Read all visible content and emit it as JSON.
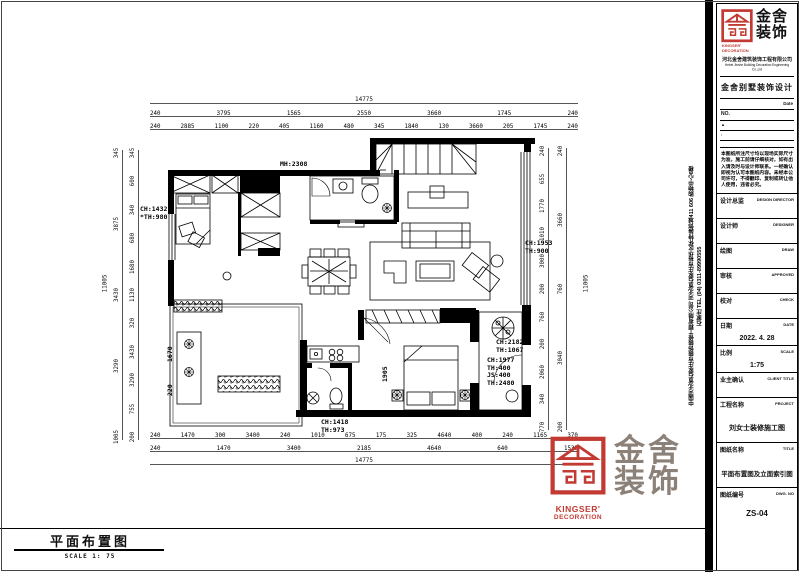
{
  "colors": {
    "brand_red": "#c23a32",
    "watermark_gray": "#8b8179"
  },
  "footer": {
    "title": "平面布置图",
    "scale": "SCALE 1: 75"
  },
  "brand": {
    "char1": "金",
    "char2": "舍",
    "char3": "装",
    "char4": "饰",
    "chars": "金舍装饰",
    "en1": "KINGSER'",
    "en2": "DECORATION"
  },
  "titleblock": {
    "company_cn": "河北金舍建筑装饰工程有限公司",
    "company_en": "Hebei Jinshe Building Decoration Engineering Co.,Ltd",
    "product": "金舍别墅装饰设计",
    "date_label": "Date",
    "no_label": "NO.",
    "tri": "▲",
    "colon": ":",
    "notice": "本图纸所注尺寸均以现场实际尺寸为准，施工前请仔细核对，如有出入请及时与设计师联系。一经确认即视为认可本图纸内容。未经本公司许可，不得翻印、复制或转让他人使用，违者必究。",
    "side_text_company": "中国河北省石家庄市装饰装修工程有限公司 河北省石家庄市裕华区怀特装饰城411 606 购物中心6楼",
    "side_text_phone": "石家庄 TEL (04) 0311-89990555",
    "fields": [
      {
        "label": "设计总监",
        "en": "DESIGN DIRECTOR",
        "value": ""
      },
      {
        "label": "设计师",
        "en": "DESIGNER",
        "value": ""
      },
      {
        "label": "绘图",
        "en": "DRAW",
        "value": ""
      },
      {
        "label": "审核",
        "en": "APPROVED",
        "value": ""
      },
      {
        "label": "校对",
        "en": "CHECK",
        "value": ""
      },
      {
        "label": "日期",
        "en": "DATE",
        "value": "2022. 4. 28"
      },
      {
        "label": "比例",
        "en": "SCALE",
        "value": "1:75"
      },
      {
        "label": "业主确认",
        "en": "CLIENT TITLE",
        "value": ""
      },
      {
        "label": "工程名称",
        "en": "PROJECT",
        "value": "刘女士装修施工图"
      },
      {
        "label": "图纸名称",
        "en": "TITLE",
        "value": "平面布置图及立面索引图"
      },
      {
        "label": "图纸编号",
        "en": "DWG. NO",
        "value": "ZS-04"
      }
    ]
  },
  "plan": {
    "labels": {
      "mh": "MH:2308",
      "ch1432": "CH:1432\n*TH:980",
      "ch1953": "CH:1953\nTH:900",
      "ch2182": "CH:2182\nTH:1067",
      "ch1977": "CH:1977\nTH:400\nJS:400\nTH:2480",
      "ch1418": "CH:1418\nTH:973",
      "d1905": "1905",
      "d1670": "1670",
      "d220": "220"
    },
    "dims": {
      "top_total": "14775",
      "top2": [
        "240",
        "3795",
        "1565",
        "2550",
        "3660",
        "1745",
        "240"
      ],
      "top3": [
        "240",
        "2885",
        "1100",
        "220",
        "405",
        "1160",
        "480",
        "345",
        "1840",
        "130",
        "3660",
        "205",
        "1745",
        "240"
      ],
      "bot1": [
        "240",
        "1470",
        "300",
        "3400",
        "240",
        "1010",
        "675",
        "175",
        "325",
        "4640",
        "400",
        "240",
        "1165",
        "370"
      ],
      "bot2": [
        "240",
        "1470",
        "3400",
        "2185",
        "4640",
        "640",
        "1535"
      ],
      "bot_total": "14775",
      "left_outer": "11005",
      "left_mid": [
        "345",
        "3875",
        "3430",
        "3290",
        "1005"
      ],
      "left_inner": [
        "345",
        "600",
        "340",
        "680",
        "1680",
        "1130",
        "320",
        "3430",
        "3290",
        "755",
        "200"
      ],
      "right_inner": [
        "240",
        "655",
        "1770",
        "1010",
        "3000",
        "200",
        "760",
        "200",
        "2060",
        "340",
        "770"
      ],
      "right_mid": [
        "240",
        "3660",
        "760",
        "3040",
        "200"
      ],
      "right_outer": "11005"
    }
  }
}
